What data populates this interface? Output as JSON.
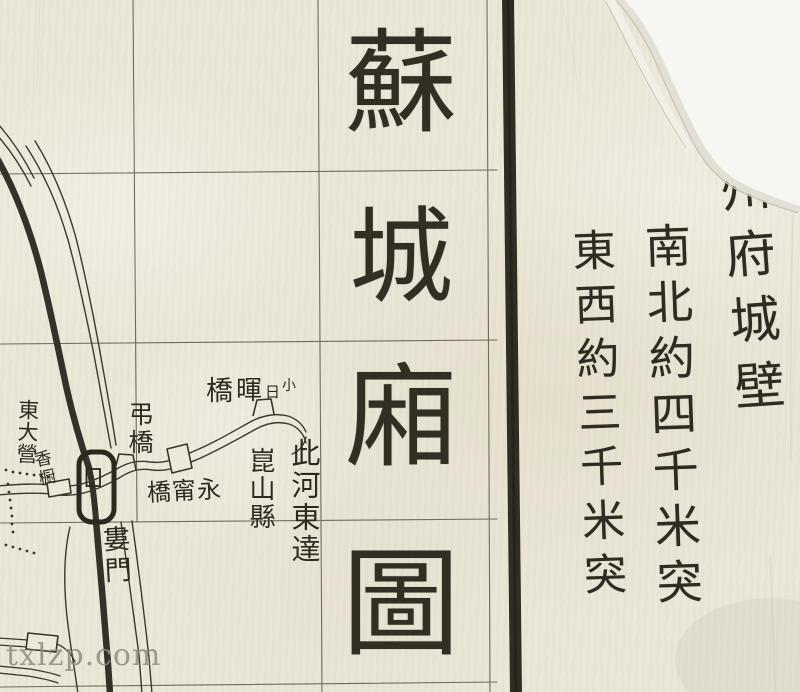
{
  "colors": {
    "paper": "#ebe7d8",
    "paper_torn_backing": "#f7f6f2",
    "ink_dark": "#26231b",
    "map_line_ink": "#3c382e",
    "grid_line": "#544e3c",
    "watermark_gray": "#8f8c80"
  },
  "title": {
    "text": "蘇城廂圖",
    "chars": [
      "蘇",
      "城",
      "廂",
      "圖"
    ]
  },
  "right_margin_notes": {
    "column1": "蘇州府城壁",
    "column2": "南北約四千米突",
    "column3": "東西約三千米突"
  },
  "map_labels": {
    "east_camp": "東大營",
    "east_camp_small": "香橱",
    "drawbridge": "弔橋",
    "yongning_bridge": "橋甯永",
    "xiaorihui_bridge_chars": [
      "橋",
      "暉",
      "日",
      "小"
    ],
    "river_note_col1": "此河東達",
    "river_note_col2": "崑山縣",
    "lou_gate": "婁門"
  },
  "watermark": "txlzp.com"
}
